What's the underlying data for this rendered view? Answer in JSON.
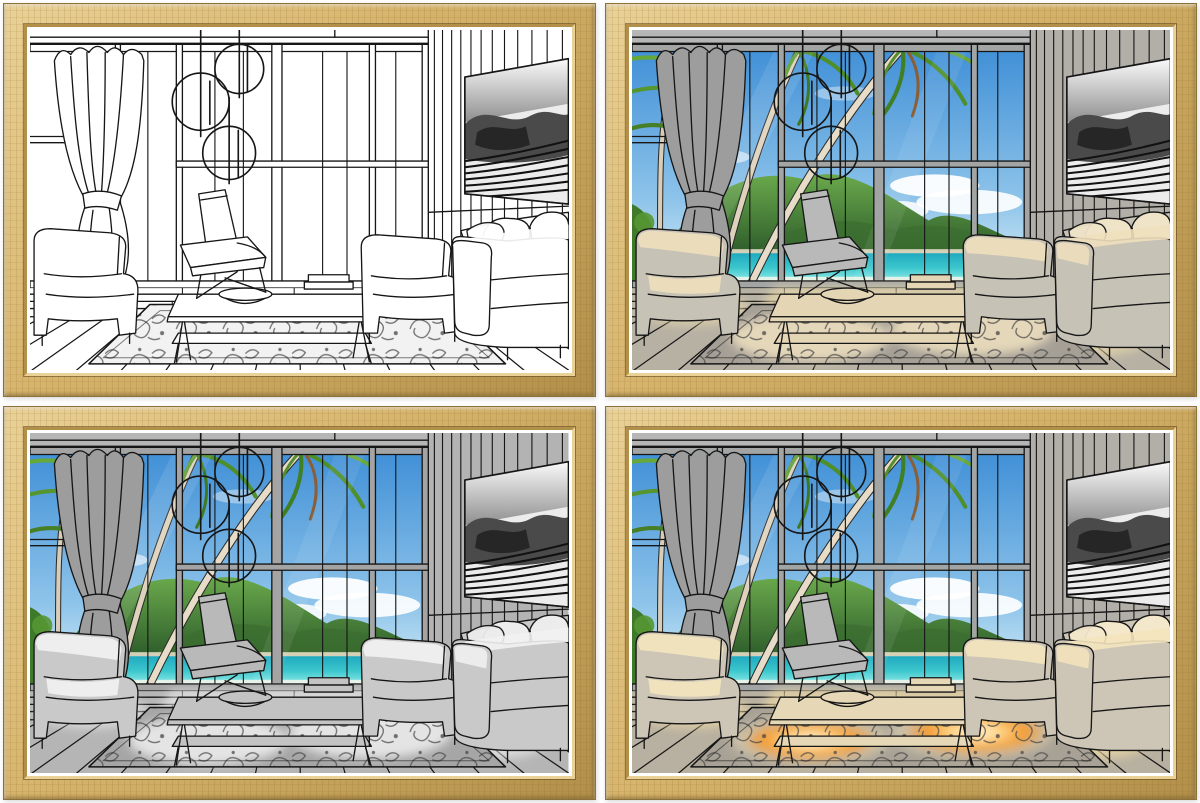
{
  "meta": {
    "description": "Product photo: four identical oak-framed art prints arranged in a 2x2 grid. Each print shows the same stylized living-room interior with a floor-to-ceiling window wall; the four prints show different lighting/coloring stages of the artwork.",
    "grid": {
      "rows": 2,
      "cols": 2
    },
    "visible_text": []
  },
  "frame": {
    "material": "light oak wood, mitred picture frame with white inner mat",
    "colors": {
      "wood": "#d5b269",
      "wood-dark": "#b3904a",
      "wood-light": "#ead196",
      "wood-edge": "#8d7238",
      "mat": "#ffffff",
      "background": "#ffffff"
    }
  },
  "scene": {
    "room_elements": [
      "tied curtain on left",
      "floor-to-ceiling window wall with gray mullions",
      "three circular pendant lamps on cords",
      "modern lounge chair",
      "two-tier coffee table with bowl and books",
      "damask patterned area rug",
      "armchair at left edge",
      "armchair and large sofa with pillows at right",
      "wall-mounted TV showing black-and-white op-art waves",
      "vertical plank wall on right",
      "diagonal wooden deck floor"
    ],
    "window_view": "tropical beach: blue sky, white clouds, green hills, turquoise sea, pale sand, leaning palm trees"
  },
  "panels": [
    {
      "id": "top-left",
      "label": "stage-1-line-art",
      "description": "Black-and-white line drawing of the living room; windows are empty white, only the rug and TV are shaded gray.",
      "theme": {
        "view-op": "0",
        "wall": "#ffffff",
        "wall2": "#ffffff",
        "mullion": "#ffffff",
        "curtain": "#ffffff",
        "floor": "#ffffff",
        "chair": "#ffffff",
        "table": "#ffffff",
        "sofa": "#ffffff",
        "sofa-hi": "#ffffff",
        "pillow": "#ffffff",
        "rug-base": "#f2f2f2",
        "rug-hi": "#ffffff",
        "rug-hi-op": "0",
        "sun-color": "#ffffff",
        "sun-op": "0",
        "glow-op": "0"
      }
    },
    {
      "id": "top-right",
      "label": "stage-2-beach-view-warm-light",
      "description": "Same room colored: tropical beach visible through windows, gray interior with warm cream sunlight on sofas, floor and rug.",
      "theme": {
        "view-op": "1",
        "wall": "#b6b6b6",
        "wall2": "#b2afa9",
        "mullion": "#a3a5a5",
        "curtain": "#9d9d9d",
        "floor": "#b7b1a4",
        "chair": "#b9b9b9",
        "table": "#e4d6b5",
        "sofa": "#c7c2b6",
        "sofa-hi": "#eedfbd",
        "pillow": "#f0e4c8",
        "rug-base": "#a59f96",
        "rug-hi": "#f0e2c0",
        "rug-hi-op": "0.85",
        "sun-color": "#f2dfae",
        "sun-op": "0.6",
        "glow-op": "0"
      }
    },
    {
      "id": "bottom-left",
      "label": "stage-3-beach-view-neutral",
      "description": "Beach visible through windows; interior in neutral grays with soft white highlights, no warm light.",
      "theme": {
        "view-op": "1",
        "wall": "#b6b6b6",
        "wall2": "#b3b3b3",
        "mullion": "#a4a4a4",
        "curtain": "#9d9d9d",
        "floor": "#b5b5b5",
        "chair": "#b9b9b9",
        "table": "#c3c3c3",
        "sofa": "#c9c9c9",
        "sofa-hi": "#f2f2f2",
        "pillow": "#ececec",
        "rug-base": "#a6a6a6",
        "rug-hi": "#f4f4f4",
        "rug-hi-op": "0.8",
        "sun-color": "#ffffff",
        "sun-op": "0.5",
        "glow-op": "0"
      }
    },
    {
      "id": "bottom-right",
      "label": "stage-4-beach-view-glowing-rug",
      "description": "Beach view with warm cream light on sofas and bright orange glowing sunlit patches on the rug.",
      "theme": {
        "view-op": "1",
        "wall": "#b6b6b6",
        "wall2": "#b2afa9",
        "mullion": "#a3a5a5",
        "curtain": "#9d9d9d",
        "floor": "#b8b0a0",
        "chair": "#b9b9b9",
        "table": "#e6d8b6",
        "sofa": "#cdc6b6",
        "sofa-hi": "#f4e4bc",
        "pillow": "#f4e8cc",
        "rug-base": "#a8a296",
        "rug-hi": "#f6e8c4",
        "rug-hi-op": "0.45",
        "sun-color": "#f4dfa8",
        "sun-op": "0.65",
        "glow-op": "1"
      }
    }
  ],
  "accent_colors": {
    "sky_top": "#3e8ed6",
    "sky_bottom": "#c6e4f4",
    "hill_green": "#4f8f33",
    "sea_turquoise": "#1fa9c0",
    "sand": "#e9e2cf",
    "palm_green": "#55962e",
    "glow_orange": "#f08c1e",
    "line_ink": "#161616"
  }
}
